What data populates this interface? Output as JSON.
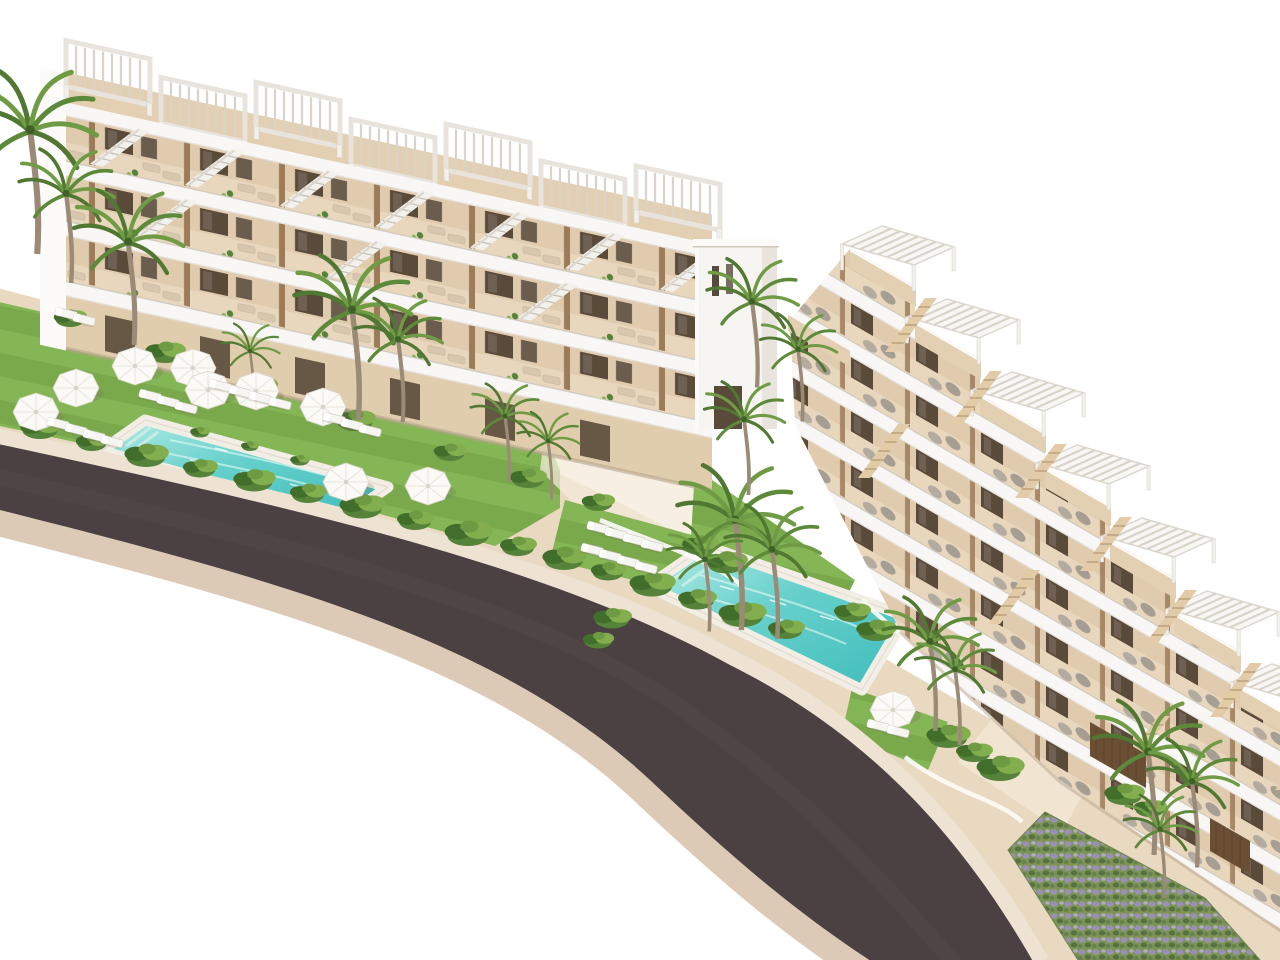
{
  "scene": {
    "type": "architectural-3d-render",
    "title": "Aerial render of a white terraced apartment complex with two pools, palm gardens and a curved asphalt road on a plain white background",
    "sky": "plain white",
    "buildings": {
      "left_block": {
        "style": "long low-rise block with white horizontal balcony bands, beige terrace decks, dark wood doors and external stairs to roof decks",
        "visible_floors": 4,
        "roof_pergolas": 7
      },
      "right_block": {
        "style": "stepped terraced duplex units descending toward the road, each with a slatted pergola roof terrace, wooden deck, stair and grey daybed cushions",
        "terraced_units_visible": 7
      },
      "link_tower": "tall white stair tower joining the two blocks"
    },
    "amenities": {
      "swimming_pools": 2,
      "parasols": 10,
      "white_sun_loungers": 26,
      "lawn_areas": 4,
      "road": "dark asphalt road curving across the foreground with light sidewalks and curbs"
    },
    "vegetation": {
      "palm_trees": 19,
      "shrub_clusters": 38,
      "lavender_bed": 1
    }
  },
  "palette": {
    "bg": "#ffffff",
    "bld-white": "#f6f5f2",
    "bld-bright": "#fcfbfa",
    "bld-shade": "#e9e5de",
    "band-line": "#cfc8bd",
    "deck": "#e3d0b2",
    "terrace-wall": "#e8d7bd",
    "terrace-wall2": "#e0cbae",
    "door": "#5a4a3a",
    "glass": "#564a3c",
    "divider": "#9b7b58",
    "lounger-tan": "#d8c7af",
    "beanbag": "#a69d93",
    "beanbag2": "#b3aaa0",
    "pool-deck": "#f2eee6",
    "pool-light": "#b5ece6",
    "pool-mid": "#66d0cb",
    "pool-deep": "#3fbcbb",
    "lawn": "#7aa94c",
    "lawn2": "#85b656",
    "bush": "#55833a",
    "bush-dark": "#426e2c",
    "bush-light": "#83ae4e",
    "palm": "#6f9b45",
    "palm-dark": "#517832",
    "palm-mid": "#5d8a3a",
    "palm-trunk": "#9a8a76",
    "sand": "#ead9c1",
    "sand-light": "#f3e9d8",
    "road": "#4b4143",
    "curb-in": "#eee3d2",
    "curb-out": "#dccab7",
    "umbrella": "#fbfaf7",
    "wall-white": "#fcfbf9",
    "lavender": "#9a8fb5",
    "lavender-base": "#7d9457",
    "stair-white": "#f3f1ed",
    "stair-wood": "#e2cba6",
    "shadow-warm": "#b5a48c"
  }
}
